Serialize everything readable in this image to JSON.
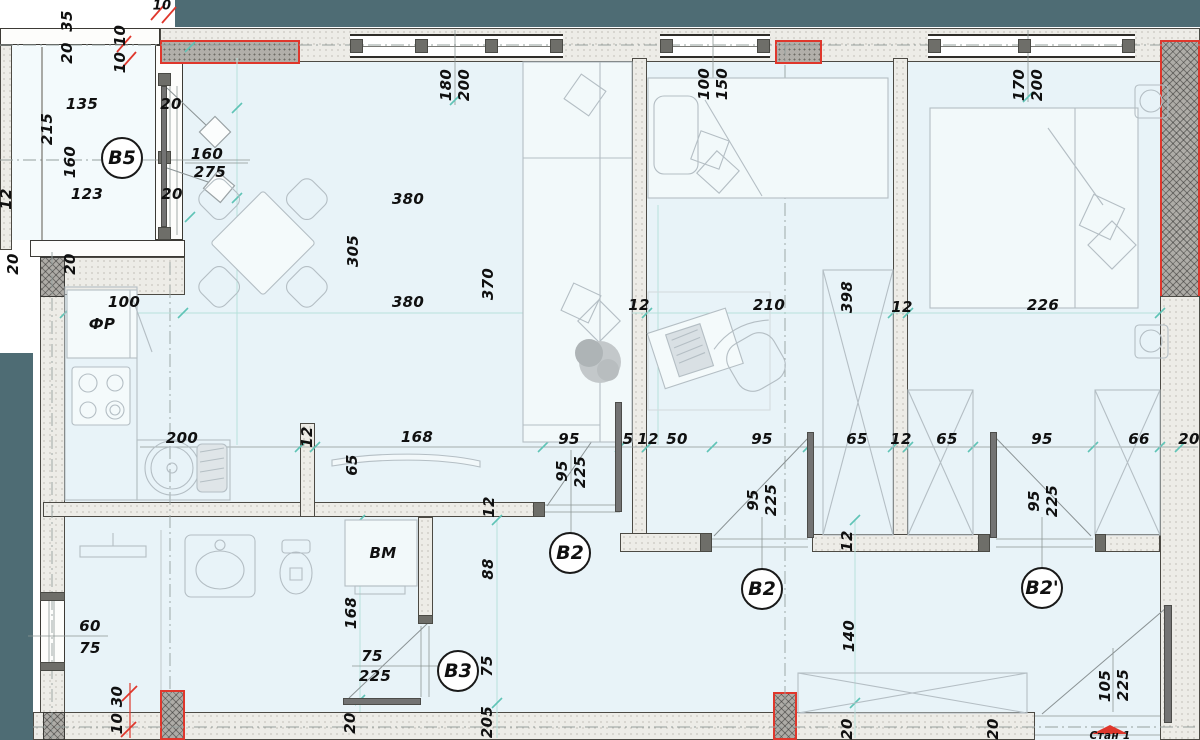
{
  "drawing": {
    "type": "apartment-floor-plan",
    "entrance_label": "Стан 1",
    "appliances": {
      "fridge": "ФР",
      "washing_machine": "BM"
    },
    "door_circles": {
      "b5": "B5",
      "b2_living": "B2",
      "b2_bedroom2": "B2",
      "b2_bedroom3": "B2'",
      "b3": "B3"
    },
    "colors": {
      "floor": "#e8f3f8",
      "balcony_floor": "#f3fafc",
      "exterior_band": "#4e6c74",
      "demolition_red": "#df372c",
      "tick_teal": "#5fc4b6",
      "wall_light": "#edece7",
      "wall_dark": "#b1afaa"
    },
    "dims": {
      "d5": "5",
      "d10": "10",
      "d10_10": "10 10",
      "d10_30": "10 30",
      "d12": "12",
      "d20": "20",
      "d35": "35",
      "d50": "50",
      "d60": "60",
      "d65": "65",
      "d66": "66",
      "d75": "75",
      "d88": "88",
      "d95": "95",
      "d100": "100",
      "d105": "105",
      "d123": "123",
      "d135": "135",
      "d140": "140",
      "d150": "150",
      "d160": "160",
      "d168": "168",
      "d170": "170",
      "d180": "180",
      "d200": "200",
      "d205": "205",
      "d210": "210",
      "d215": "215",
      "d225": "225",
      "d226": "226",
      "d275": "275",
      "d305": "305",
      "d370": "370",
      "d380": "380",
      "d398": "398"
    }
  }
}
